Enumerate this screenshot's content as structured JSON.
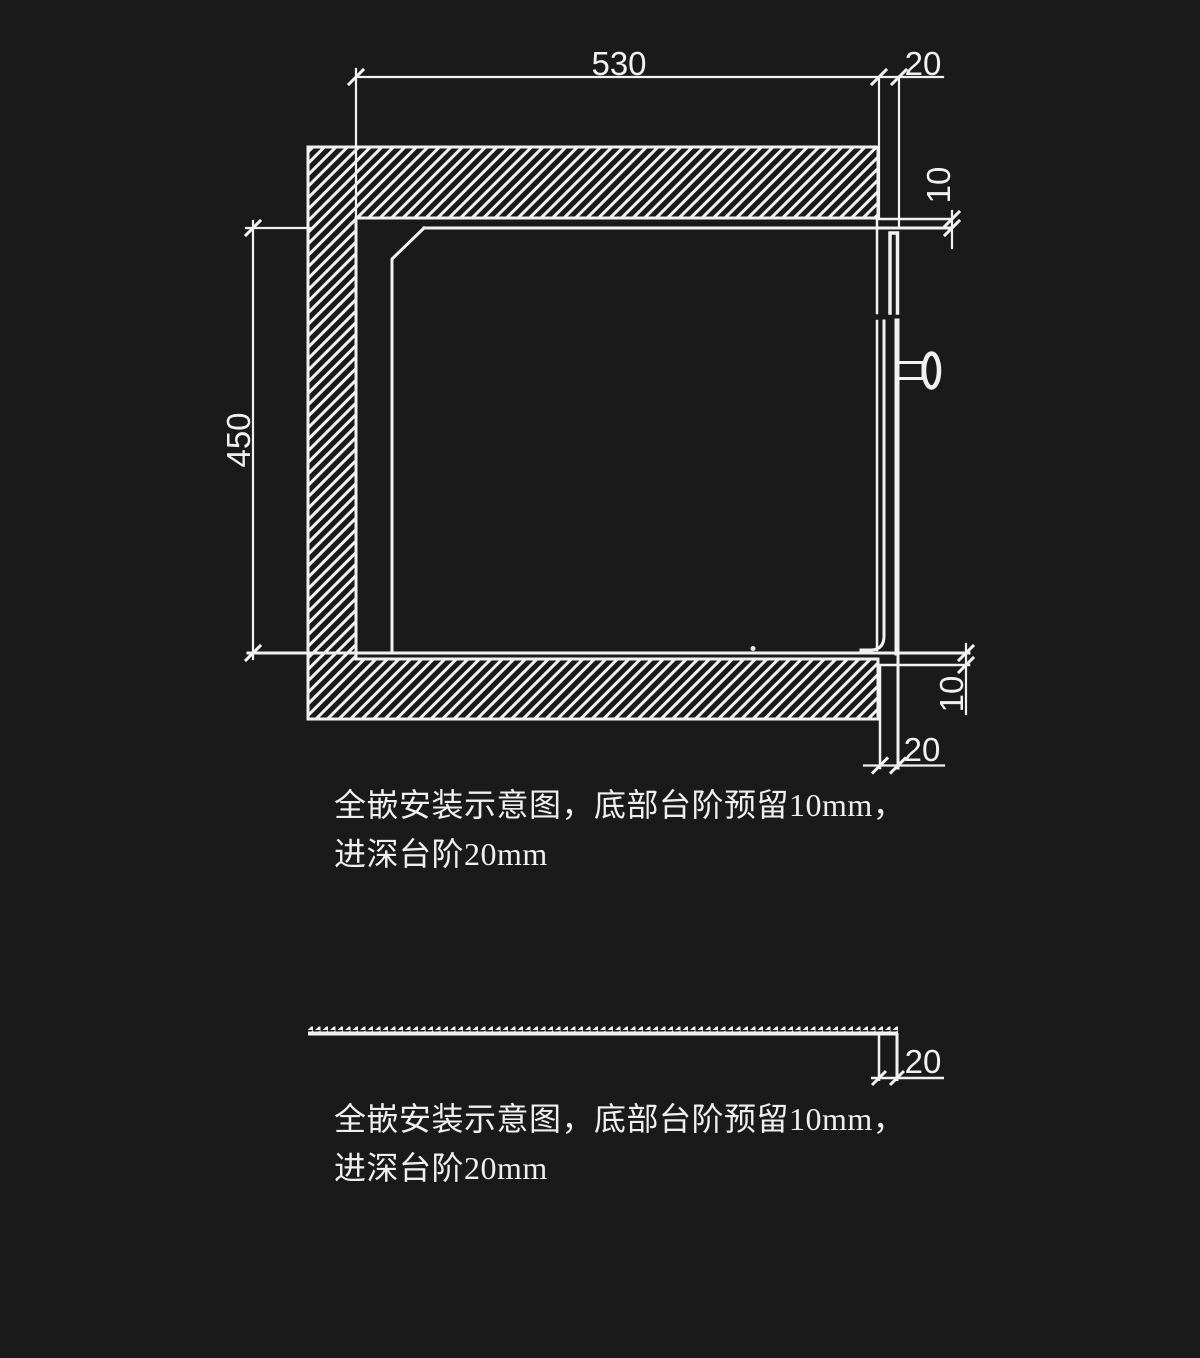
{
  "colors": {
    "background": "#1a1a1b",
    "line": "#f1f1f1",
    "text": "#efefef"
  },
  "main_diagram": {
    "dim_width": "530",
    "dim_top_step": "20",
    "dim_top_gap": "10",
    "dim_height": "450",
    "dim_bottom_gap": "10",
    "dim_bottom_step": "20"
  },
  "lower_diagram": {
    "dim_step": "20"
  },
  "captions": [
    {
      "line1": "全嵌安装示意图，底部台阶预留10mm，",
      "line2": "进深台阶20mm"
    },
    {
      "line1": "全嵌安装示意图，底部台阶预留10mm，",
      "line2": "进深台阶20mm"
    }
  ]
}
